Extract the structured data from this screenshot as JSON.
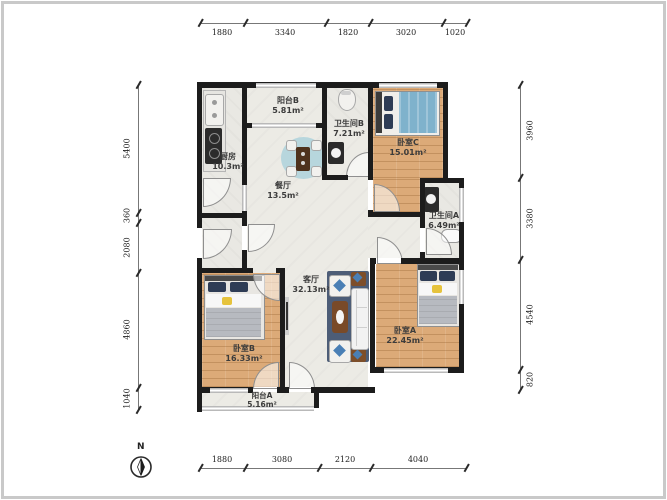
{
  "rooms": [
    {
      "id": "kitchen",
      "name": "厨房",
      "area": "10.3m²"
    },
    {
      "id": "balcony-b",
      "name": "阳台B",
      "area": "5.81m²"
    },
    {
      "id": "bathroom-b",
      "name": "卫生间B",
      "area": "7.21m²"
    },
    {
      "id": "bedroom-c",
      "name": "卧室C",
      "area": "15.01m²"
    },
    {
      "id": "dining-room",
      "name": "餐厅",
      "area": "13.5m²"
    },
    {
      "id": "bathroom-a",
      "name": "卫生间A",
      "area": "6.49m²"
    },
    {
      "id": "living-room",
      "name": "客厅",
      "area": "32.13m²"
    },
    {
      "id": "bedroom-b",
      "name": "卧室B",
      "area": "16.33m²"
    },
    {
      "id": "bedroom-a",
      "name": "卧室A",
      "area": "22.45m²"
    },
    {
      "id": "balcony-a",
      "name": "阳台A",
      "area": "5.16m²"
    }
  ],
  "dimensions": {
    "top": [
      "1880",
      "3340",
      "1820",
      "3020",
      "1020"
    ],
    "bottom": [
      "1880",
      "3080",
      "2120",
      "4040"
    ],
    "left": [
      "5400",
      "360",
      "2080",
      "4860",
      "1040"
    ],
    "right": [
      "3960",
      "3380",
      "4540",
      "820"
    ]
  },
  "compass": {
    "label": "N"
  },
  "colors": {
    "wall": "#1c1c1c",
    "wood_floor": "#dcaa78",
    "tile_floor": "#e9e8e3",
    "bed_blue": "#7fb2cc",
    "rug_navy": "#4d5d77",
    "accent_yellow": "#e6c33c",
    "window_gray": "#b9b9b9"
  }
}
